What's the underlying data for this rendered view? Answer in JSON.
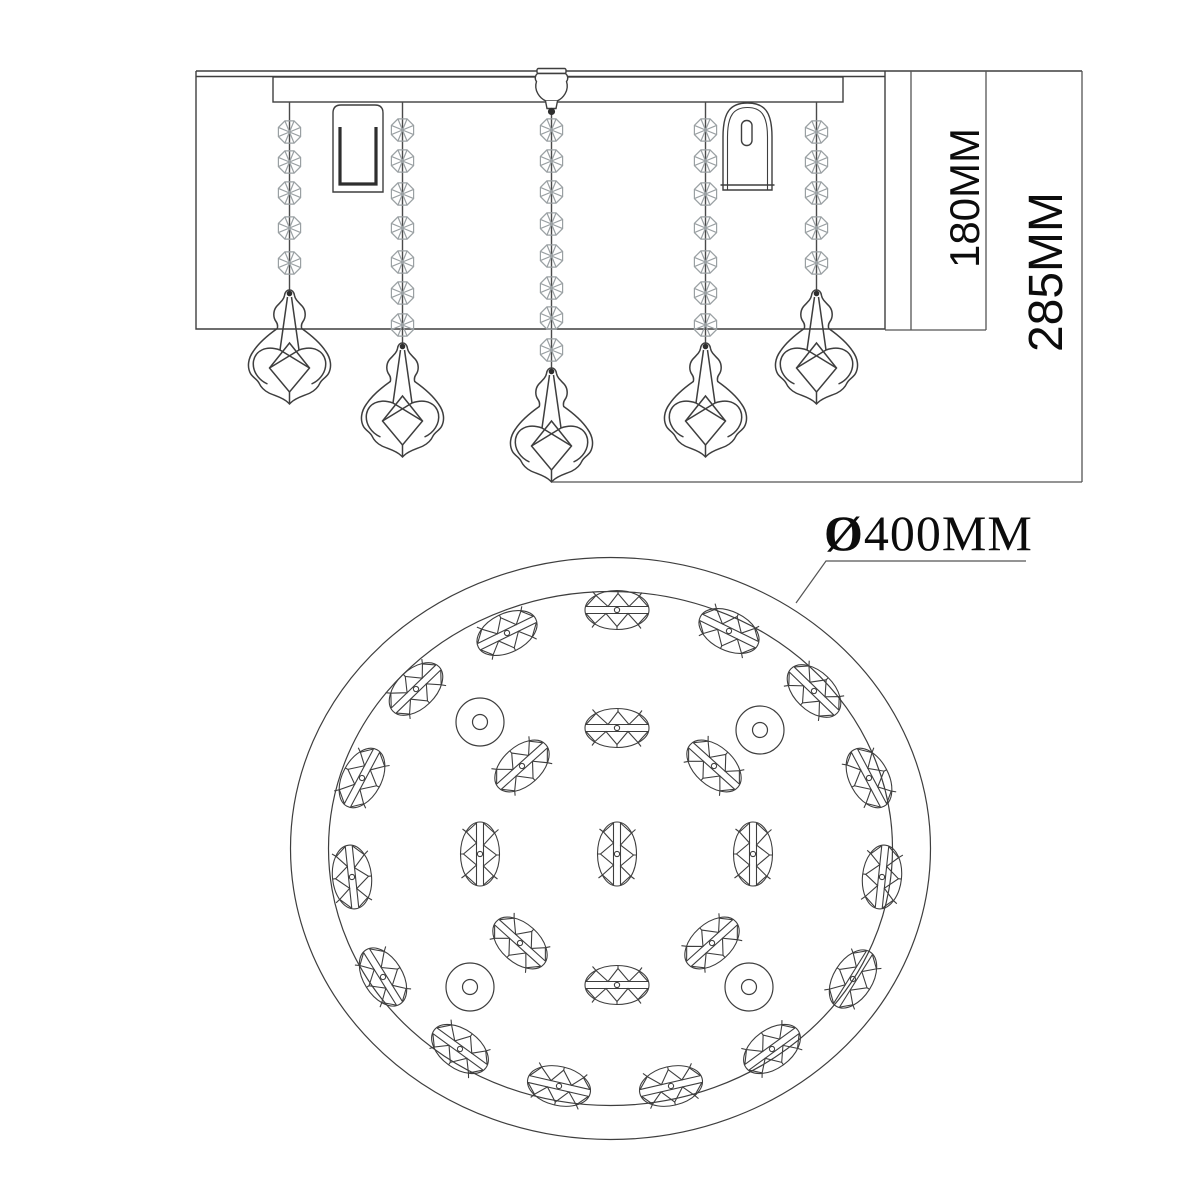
{
  "drawing": {
    "type": "technical dimension drawing",
    "subject": "crystal ceiling lamp, side elevation and bottom plan view"
  },
  "labels": {
    "inner_height": "180MM",
    "total_height": "285MM",
    "diameter_symbol": "Ø",
    "diameter_value": "400MM"
  },
  "colors": {
    "line": "#3e3e3e",
    "thin_line": "#555555",
    "bead": "#9aa0a3",
    "dark": "#2e2e2e",
    "text": "#0c0c0c",
    "background": "#ffffff"
  },
  "side_view": {
    "ceiling": {
      "x1": 196,
      "x2": 885,
      "ext_x2": 1082,
      "y_top": 71,
      "y_bottom": 76.5
    },
    "box": {
      "x1": 196,
      "y1": 71,
      "x2": 885,
      "y2": 329
    },
    "plate": {
      "x1": 273,
      "y1": 77,
      "x2": 843,
      "y2": 102
    },
    "finial": {
      "cx": 551.5,
      "cap_y": 68.5,
      "ball_y": 111.5
    },
    "sockets": {
      "left": {
        "x": 333,
        "y": 105,
        "w": 50,
        "h": 87
      },
      "right": {
        "x": 723,
        "y": 103,
        "w": 49,
        "h": 87
      }
    },
    "strands": [
      {
        "x": 289.5,
        "top": 102,
        "beads": [
          132,
          162,
          193,
          228,
          263
        ],
        "pendant_top": 290
      },
      {
        "x": 402.5,
        "top": 102,
        "beads": [
          130,
          161,
          194,
          228,
          262,
          293,
          325
        ],
        "pendant_top": 343
      },
      {
        "x": 551.5,
        "top": 111,
        "beads": [
          130,
          161,
          192,
          224,
          256,
          288,
          318,
          350
        ],
        "pendant_top": 368
      },
      {
        "x": 705.5,
        "top": 102,
        "beads": [
          130,
          161,
          194,
          228,
          262,
          293,
          325
        ],
        "pendant_top": 343
      },
      {
        "x": 816.5,
        "top": 102,
        "beads": [
          132,
          162,
          193,
          228,
          263
        ],
        "pendant_top": 290
      }
    ],
    "dim_180": {
      "vline1_x": 911,
      "vline2_x": 986,
      "y1": 71,
      "y2": 330,
      "ext_x1": 885
    },
    "dim_285": {
      "vline_x": 1082,
      "y1": 71,
      "y2": 482,
      "ext_x1": 552
    }
  },
  "top_view": {
    "center": {
      "x": 610.5,
      "y": 848.5
    },
    "outer_ring": {
      "rx": 320,
      "ry": 291
    },
    "inner_ring": {
      "rx": 282,
      "ry": 257
    },
    "leader_points": "796,603 826,561 1026,561",
    "crystals": [
      [
        617,
        610,
        0
      ],
      [
        507,
        633,
        -26
      ],
      [
        729,
        631,
        26
      ],
      [
        416,
        689,
        -44
      ],
      [
        814,
        691,
        44
      ],
      [
        617,
        728,
        0
      ],
      [
        522,
        766,
        -42
      ],
      [
        714,
        766,
        42
      ],
      [
        362,
        778,
        -62
      ],
      [
        869,
        778,
        62
      ],
      [
        352,
        877,
        84
      ],
      [
        480,
        854,
        90
      ],
      [
        617,
        854,
        90
      ],
      [
        753,
        854,
        90
      ],
      [
        882,
        877,
        -84
      ],
      [
        383,
        977,
        58
      ],
      [
        520,
        943,
        42
      ],
      [
        712,
        943,
        -42
      ],
      [
        853,
        979,
        -58
      ],
      [
        617,
        985,
        0
      ],
      [
        460,
        1049,
        36
      ],
      [
        772,
        1049,
        -36
      ],
      [
        559,
        1086,
        13
      ],
      [
        671,
        1086,
        -13
      ]
    ],
    "washers": [
      [
        480,
        722
      ],
      [
        760,
        730
      ],
      [
        470,
        987
      ],
      [
        749,
        987
      ]
    ]
  }
}
